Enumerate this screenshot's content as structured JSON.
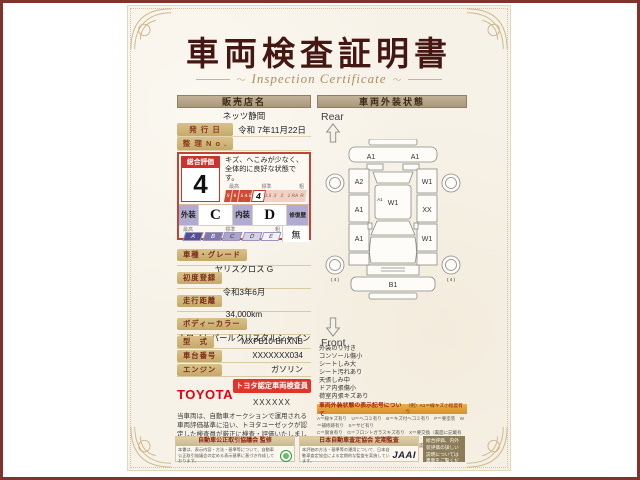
{
  "colors": {
    "frame_red": "#7e342c",
    "title_maroon": "#451712",
    "accent_red": "#c0392b",
    "toyota_red": "#e10012",
    "lavender": "#b2abd1",
    "legend_orange": "#e2a03c",
    "tan_header": "#b2a086",
    "label_tan": "#cdb479",
    "footer_dark": "#8c7c57"
  },
  "title": "車両検査証明書",
  "subtitle": "Inspection Certificate",
  "ornament": "〜",
  "left": {
    "dealer": {
      "header": "販売店名",
      "name": "ネッツ静岡"
    },
    "issue": {
      "label": "発 行 日",
      "value": "令和 7年11月22日"
    },
    "refno": {
      "label": "整 理 N o .",
      "value": ""
    },
    "rating": {
      "label": "総合評価",
      "value": "4",
      "comment": "キズ、へこみが少なく、全体的に良好な状態です。",
      "scale_top": {
        "best": "最高",
        "mid": "標準",
        "poor": "粗"
      },
      "scale": [
        "S",
        "6",
        "5",
        "4.5",
        "4",
        "3.5",
        "3",
        "2",
        "1",
        "RA",
        "R"
      ]
    },
    "grade": {
      "exterior_label": "外装",
      "exterior": "C",
      "interior_label": "内装",
      "interior": "D",
      "repair_label": "修復歴",
      "repair": "無",
      "scale": [
        "A",
        "B",
        "C",
        "D",
        "E"
      ]
    },
    "details": [
      {
        "label": "車種・グレード",
        "value": "ヤリスクロス G"
      },
      {
        "label": "初度登録",
        "value": "令和3年6月"
      },
      {
        "label": "走行距離",
        "value": "34,000km"
      },
      {
        "label": "ボディーカラー",
        "value": "ホワイトパールクリスタルシャイン"
      },
      {
        "label": "型　式",
        "value": "MXPB10-BHXNB"
      },
      {
        "label": "車台番号",
        "value": "XXXXXXX034"
      },
      {
        "label": "エンジン",
        "value": "ガソリン"
      }
    ],
    "toyota": {
      "logo": "TOYOTA",
      "cert": "トヨタ認定車両検査員",
      "id": "XXXXXX"
    },
    "disclaimer": "当車両は、自動車オークションで運用される車両評価基準に沿い、トヨタユーゼックが認定した検査員が厳正に検査・評価いたしました。"
  },
  "right": {
    "header": "車両外装状態",
    "rear": "Rear",
    "front": "Front",
    "diagram": {
      "rear_bumper_l": "A1",
      "rear_bumper_r": "A1",
      "rear_quarter_l": "A2",
      "rear_quarter_r": "W1",
      "door_upper_l": "A1",
      "door_upper_r": "XX",
      "door_lower_l": "A1",
      "door_lower_r": "W1",
      "pillar": "A1",
      "roof": "W1",
      "front_bumper": "B1",
      "tire_l": "( 4 )",
      "tire_r": "( 4 )"
    },
    "notes": [
      "外装のり付き",
      "コンソール傷小",
      "シートしみ大",
      "シート汚れあり",
      "天張しみ中",
      "ドア内張傷小",
      "荷室内張キズあり"
    ],
    "legend": {
      "title": "車両外装状態の表示記号について",
      "example": "（例）A1＝線キズ小程度有り",
      "lines": [
        "A＝線キズ有り　U＝ヘコミ有り　B＝キズ付ヘコミ有り　P＝要塗装　W＝補修跡有り　S＝サビ有り",
        "C＝腐食有り　G＝フロントガラスキズ有り　X＝要交換（裏面に記載有り）　XX＝交換済有り",
        "1＝小程度　2＝中程度　3＝中程度以上　※トヨタ認定車両検査員が検査をおこなっています。"
      ]
    }
  },
  "footer": {
    "fair": {
      "header": "自動車公正取引協議会 監修",
      "body": "本書は、表示内容・方法・基準等について、自動車公正取引協議会の定める表示基準に基づき作成しております。"
    },
    "jaai": {
      "header": "日本自動車査定協会 定期監査",
      "body": "本評価の方法・基準等の運用について、日本自動車査定協会による定期的な監査を実施しています。",
      "logo": "JAAI"
    },
    "note": "総合評価、内外装評価の詳しい説明については裏面をご覧ください。"
  }
}
